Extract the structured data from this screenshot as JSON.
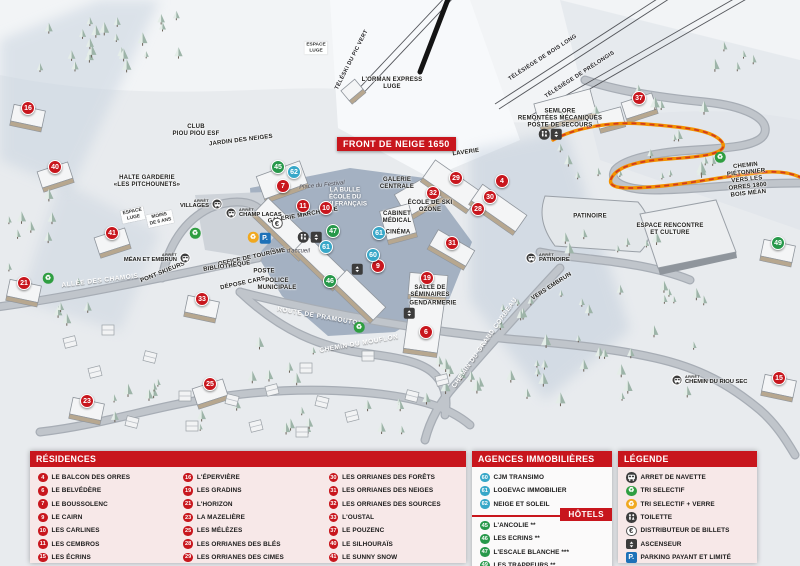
{
  "banner": "FRONT DE NEIGE 1650",
  "colors": {
    "residence": "#c8161d",
    "hotel": "#27984a",
    "agence": "#38a7c8",
    "header_red": "#c8161d",
    "panel_pink": "#f7e8e8",
    "parking_blue": "#1d71b8",
    "tri_green": "#2f9e41",
    "tri_yellow": "#f0a81f",
    "path_orange": "#f39200",
    "path_red": "#d23b1e"
  },
  "map": {
    "markers": [
      {
        "n": "16",
        "kind": "residence",
        "x": 28,
        "y": 108
      },
      {
        "n": "40",
        "kind": "residence",
        "x": 55,
        "y": 167
      },
      {
        "n": "21",
        "kind": "residence",
        "x": 24,
        "y": 283
      },
      {
        "n": "41",
        "kind": "residence",
        "x": 112,
        "y": 233
      },
      {
        "n": "23",
        "kind": "residence",
        "x": 87,
        "y": 401
      },
      {
        "n": "25",
        "kind": "residence",
        "x": 210,
        "y": 384
      },
      {
        "n": "33",
        "kind": "residence",
        "x": 202,
        "y": 299
      },
      {
        "n": "7",
        "kind": "residence",
        "x": 283,
        "y": 186
      },
      {
        "n": "11",
        "kind": "residence",
        "x": 303,
        "y": 206
      },
      {
        "n": "10",
        "kind": "residence",
        "x": 326,
        "y": 208
      },
      {
        "n": "9",
        "kind": "residence",
        "x": 378,
        "y": 266
      },
      {
        "n": "6",
        "kind": "residence",
        "x": 426,
        "y": 332
      },
      {
        "n": "29",
        "kind": "residence",
        "x": 456,
        "y": 178
      },
      {
        "n": "4",
        "kind": "residence",
        "x": 502,
        "y": 181
      },
      {
        "n": "32",
        "kind": "residence",
        "x": 433,
        "y": 193
      },
      {
        "n": "30",
        "kind": "residence",
        "x": 490,
        "y": 197
      },
      {
        "n": "28",
        "kind": "residence",
        "x": 478,
        "y": 209
      },
      {
        "n": "31",
        "kind": "residence",
        "x": 452,
        "y": 243
      },
      {
        "n": "19",
        "kind": "residence",
        "x": 427,
        "y": 278
      },
      {
        "n": "37",
        "kind": "residence",
        "x": 639,
        "y": 98
      },
      {
        "n": "15",
        "kind": "residence",
        "x": 779,
        "y": 378
      },
      {
        "n": "45",
        "kind": "hotel",
        "x": 278,
        "y": 167
      },
      {
        "n": "47",
        "kind": "hotel",
        "x": 333,
        "y": 231
      },
      {
        "n": "46",
        "kind": "hotel",
        "x": 330,
        "y": 281
      },
      {
        "n": "49",
        "kind": "hotel",
        "x": 778,
        "y": 243
      },
      {
        "n": "62",
        "kind": "agence",
        "x": 294,
        "y": 172
      },
      {
        "n": "61",
        "kind": "agence",
        "x": 326,
        "y": 247
      },
      {
        "n": "61",
        "kind": "agence",
        "x": 379,
        "y": 233
      },
      {
        "n": "60",
        "kind": "agence",
        "x": 373,
        "y": 255
      }
    ],
    "stop_prefix": "ARRÊT",
    "bus_stops": [
      {
        "label": "VILLAGES",
        "x": 217,
        "y": 204,
        "side": "left"
      },
      {
        "label": "CHAMP LACAS",
        "x": 231,
        "y": 213,
        "side": "right"
      },
      {
        "label": "MÉAN ET EMBRUN",
        "x": 185,
        "y": 258,
        "side": "left"
      },
      {
        "label": "PATINOIRE",
        "x": 531,
        "y": 258,
        "side": "right"
      },
      {
        "label": "CHEMIN DU RIOU SEC",
        "x": 677,
        "y": 380,
        "side": "right"
      }
    ],
    "amenities": [
      {
        "icon": "euro",
        "x": 277,
        "y": 223
      },
      {
        "icon": "parking",
        "x": 265,
        "y": 238
      },
      {
        "icon": "recycle-glass",
        "x": 253,
        "y": 237
      },
      {
        "icon": "recycle",
        "x": 195,
        "y": 233
      },
      {
        "icon": "recycle",
        "x": 48,
        "y": 278
      },
      {
        "icon": "recycle",
        "x": 359,
        "y": 327
      },
      {
        "icon": "recycle",
        "x": 720,
        "y": 157
      },
      {
        "icon": "toilet",
        "x": 303,
        "y": 237
      },
      {
        "icon": "elevator",
        "x": 316,
        "y": 237
      },
      {
        "icon": "elevator",
        "x": 357,
        "y": 269
      },
      {
        "icon": "toilet",
        "x": 544,
        "y": 134
      },
      {
        "icon": "elevator",
        "x": 556,
        "y": 134
      },
      {
        "icon": "elevator",
        "x": 409,
        "y": 313
      }
    ],
    "labels": [
      {
        "text": "L'ORMAN EXPRESS\nLUGE",
        "x": 392,
        "y": 84,
        "cls": "poi"
      },
      {
        "text": "TÉLÉSKI DU PIC VERT",
        "x": 352,
        "y": 60,
        "cls": "lift",
        "rot": -63
      },
      {
        "text": "TÉLÉSIÈGE DE BOIS LONG",
        "x": 543,
        "y": 58,
        "cls": "lift",
        "rot": -33
      },
      {
        "text": "TÉLÉSIÈGE DE PRÉLONGIS",
        "x": 580,
        "y": 75,
        "cls": "lift",
        "rot": -33
      },
      {
        "text": "SEMLORE\nREMONTÉES MÉCANIQUES\nPOSTE DE SECOURS",
        "x": 560,
        "y": 119,
        "cls": "poi"
      },
      {
        "text": "ESPACE\nLUGE",
        "x": 316,
        "y": 48,
        "cls": "poi-box"
      },
      {
        "text": "CLUB\nPIOU PIOU ESF",
        "x": 196,
        "y": 131,
        "cls": "poi"
      },
      {
        "text": "JARDIN DES NEIGES",
        "x": 241,
        "y": 141,
        "cls": "poi",
        "rot": -7
      },
      {
        "text": "HALTE GARDERIE\n«LES PITCHOUNETS»",
        "x": 147,
        "y": 182,
        "cls": "poi"
      },
      {
        "text": "ESPACE\nLUGE",
        "x": 133,
        "y": 215,
        "cls": "poi-box",
        "rot": -12
      },
      {
        "text": "MOINS\nDE 6 ANS",
        "x": 160,
        "y": 219,
        "cls": "poi-box",
        "rot": -12
      },
      {
        "text": "Place du Festival",
        "x": 322,
        "y": 186,
        "cls": "place",
        "rot": -6
      },
      {
        "text": "LA BULLE\nÉCOLE DU\nSKI FRANÇAIS",
        "x": 345,
        "y": 197,
        "cls": "poi-white"
      },
      {
        "text": "GALERIE MARCHANDE",
        "x": 303,
        "y": 216,
        "cls": "poi",
        "rot": -10
      },
      {
        "text": "GALERIE\nCENTRALE",
        "x": 397,
        "y": 184,
        "cls": "poi"
      },
      {
        "text": "LAVERIE",
        "x": 466,
        "y": 153,
        "cls": "poi",
        "rot": -8
      },
      {
        "text": "ÉCOLE DE SKI\nOZONE",
        "x": 430,
        "y": 207,
        "cls": "poi"
      },
      {
        "text": "CABINET\nMÉDICAL",
        "x": 397,
        "y": 218,
        "cls": "poi"
      },
      {
        "text": "CINÉMA",
        "x": 398,
        "y": 233,
        "cls": "poi"
      },
      {
        "text": "Place d'accueil",
        "x": 290,
        "y": 252,
        "cls": "place"
      },
      {
        "text": "OFFICE DE TOURISME",
        "x": 252,
        "y": 258,
        "cls": "poi",
        "rot": -12
      },
      {
        "text": "BIBLIOTHÈQUE",
        "x": 227,
        "y": 267,
        "cls": "poi",
        "rot": -8
      },
      {
        "text": "POSTE",
        "x": 264,
        "y": 272,
        "cls": "poi"
      },
      {
        "text": "DÉPOSE CARS",
        "x": 243,
        "y": 284,
        "cls": "poi",
        "rot": -12
      },
      {
        "text": "POLICE\nMUNICIPALE",
        "x": 277,
        "y": 285,
        "cls": "poi"
      },
      {
        "text": "PONT SKIEURS",
        "x": 163,
        "y": 273,
        "cls": "poi",
        "rot": -22
      },
      {
        "text": "ALLÉE DES CHAMOIS",
        "x": 100,
        "y": 281,
        "cls": "road",
        "rot": -7
      },
      {
        "text": "ROUTE DE PRAMOUTON",
        "x": 320,
        "y": 317,
        "cls": "road",
        "rot": 10
      },
      {
        "text": "CHEMIN DU MOUFLON",
        "x": 359,
        "y": 344,
        "cls": "road",
        "rot": -10
      },
      {
        "text": "CHEMIN DU GRAND CORBEAU",
        "x": 485,
        "y": 343,
        "cls": "road",
        "rot": -55
      },
      {
        "text": "SALLE DE\nSÉMINAIRES",
        "x": 430,
        "y": 292,
        "cls": "poi"
      },
      {
        "text": "GENDARMERIE",
        "x": 433,
        "y": 304,
        "cls": "poi"
      },
      {
        "text": "PATINOIRE",
        "x": 590,
        "y": 217,
        "cls": "poi"
      },
      {
        "text": "ESPACE RENCONTRE\nET CULTURE",
        "x": 670,
        "y": 230,
        "cls": "poi"
      },
      {
        "text": "VERS EMBRUN",
        "x": 552,
        "y": 287,
        "cls": "poi",
        "rot": -33
      },
      {
        "text": "CHEMIN PIÉTONNIER\nVERS LES ORRES 1800\nBOIS MÉAN",
        "x": 747,
        "y": 180,
        "cls": "poi",
        "rot": -6
      }
    ]
  },
  "panels": {
    "residences": {
      "title": "RÉSIDENCES",
      "columns": [
        [
          {
            "n": "4",
            "label": "LE BALCON DES ORRES"
          },
          {
            "n": "6",
            "label": "LE BELVÉDÈRE"
          },
          {
            "n": "7",
            "label": "LE BOUSSOLENC"
          },
          {
            "n": "9",
            "label": "LE CAIRN"
          },
          {
            "n": "10",
            "label": "LES CARLINES"
          },
          {
            "n": "11",
            "label": "LES CEMBROS"
          },
          {
            "n": "15",
            "label": "LES ÉCRINS"
          }
        ],
        [
          {
            "n": "16",
            "label": "L'ÉPERVIÈRE"
          },
          {
            "n": "19",
            "label": "LES GRADINS"
          },
          {
            "n": "21",
            "label": "L'HORIZON"
          },
          {
            "n": "23",
            "label": "LA MAZELIÈRE"
          },
          {
            "n": "25",
            "label": "LES MÉLÈZES"
          },
          {
            "n": "28",
            "label": "LES ORRIANES DES BLÉS"
          },
          {
            "n": "29",
            "label": "LES ORRIANES DES CIMES"
          }
        ],
        [
          {
            "n": "30",
            "label": "LES ORRIANES DES FORÊTS"
          },
          {
            "n": "31",
            "label": "LES ORRIANES DES NEIGES"
          },
          {
            "n": "32",
            "label": "LES ORRIANES DES SOURCES"
          },
          {
            "n": "33",
            "label": "L'OUSTAL"
          },
          {
            "n": "37",
            "label": "LE POUZENC"
          },
          {
            "n": "40",
            "label": "LE SILHOURAÏS"
          },
          {
            "n": "41",
            "label": "LE SUNNY SNOW"
          }
        ]
      ]
    },
    "agences": {
      "title": "AGENCES IMMOBILIÈRES",
      "items": [
        {
          "n": "60",
          "label": "CJM TRANSIMO"
        },
        {
          "n": "61",
          "label": "LOGEVAC IMMOBILIER"
        },
        {
          "n": "62",
          "label": "NEIGE ET SOLEIL"
        }
      ]
    },
    "hotels": {
      "title": "HÔTELS",
      "items": [
        {
          "n": "45",
          "label": "L'ANCOLIE **"
        },
        {
          "n": "46",
          "label": "LES ECRINS **"
        },
        {
          "n": "47",
          "label": "L'ESCALE BLANCHE ***"
        },
        {
          "n": "49",
          "label": "LES TRAPPEURS **"
        }
      ]
    },
    "legende": {
      "title": "LÉGENDE",
      "items": [
        {
          "icon": "bus",
          "label": "ARRET DE NAVETTE"
        },
        {
          "icon": "recycle",
          "label": "TRI SELECTIF"
        },
        {
          "icon": "recycle-glass",
          "label": "TRI SELECTIF + VERRE"
        },
        {
          "icon": "toilet",
          "label": "TOILETTE"
        },
        {
          "icon": "euro",
          "label": "DISTRIBUTEUR DE BILLETS"
        },
        {
          "icon": "elevator",
          "label": "ASCENSEUR"
        },
        {
          "icon": "parking",
          "label": "PARKING PAYANT ET LIMITÉ"
        }
      ]
    }
  }
}
